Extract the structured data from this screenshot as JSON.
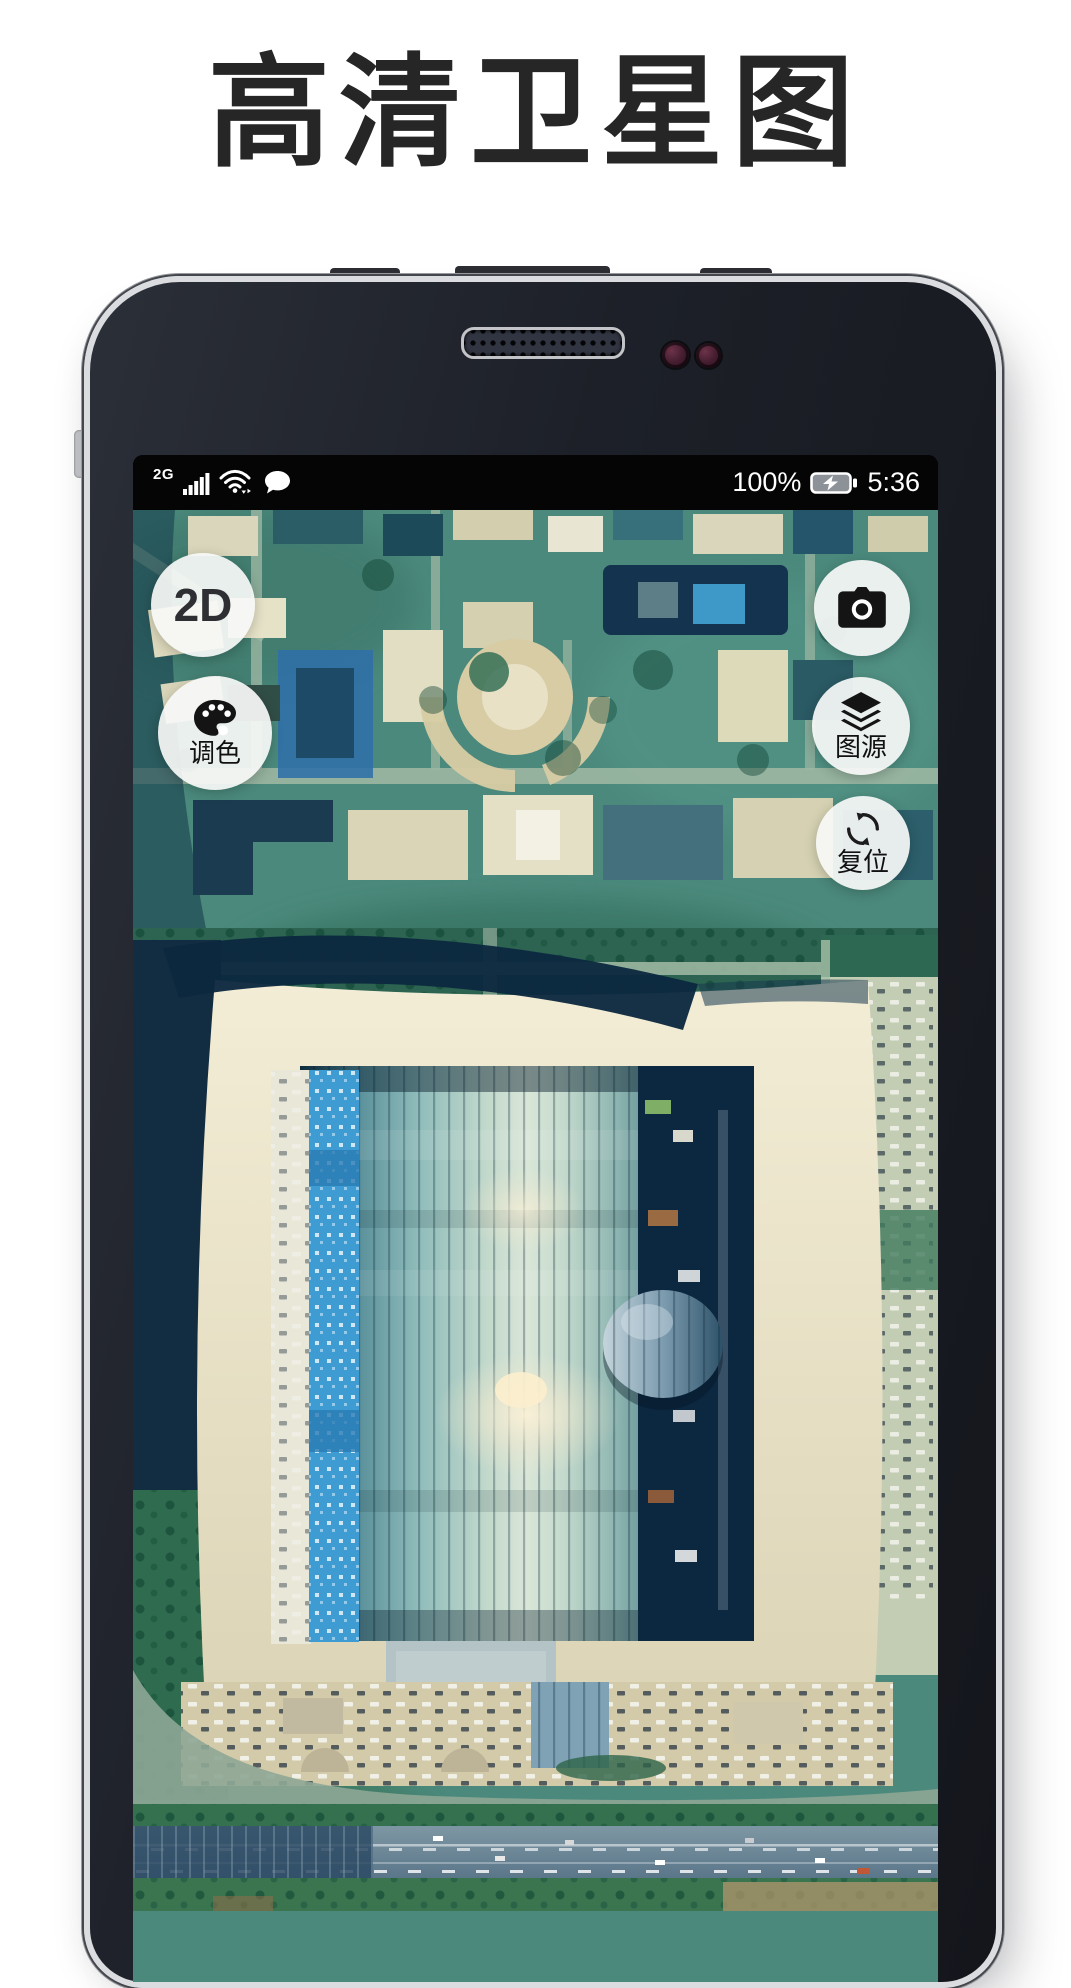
{
  "title": "高清卫星图",
  "phone": {
    "status_bar": {
      "network": "2G",
      "battery_percent": "100%",
      "time": "5:36"
    },
    "map": {
      "controls_left": [
        {
          "id": "view-2d",
          "label": "2D"
        },
        {
          "id": "palette",
          "label": "调色",
          "icon": "palette-icon"
        }
      ],
      "controls_right": [
        {
          "id": "camera",
          "label": "",
          "icon": "camera-icon"
        },
        {
          "id": "source",
          "label": "图源",
          "icon": "layers-icon"
        },
        {
          "id": "reset",
          "label": "复位",
          "icon": "refresh-icon"
        }
      ]
    }
  },
  "icons": {
    "signal": "signal-bars-icon",
    "wifi": "wifi-icon",
    "message": "message-bubble-icon",
    "battery": "battery-charging-icon"
  },
  "colors": {
    "map_base": "#4b897c",
    "stadium_roof": "#efe8d0",
    "stadium_glass_light": "#d9e6d8",
    "stadium_glass_dark": "#153f52",
    "accent_blue": "#3f9cd2",
    "deep_navy": "#0d2940",
    "road_sage": "#9cb7a2",
    "button_bg": "#f5f6f5",
    "status_bar_bg": "#050505"
  }
}
